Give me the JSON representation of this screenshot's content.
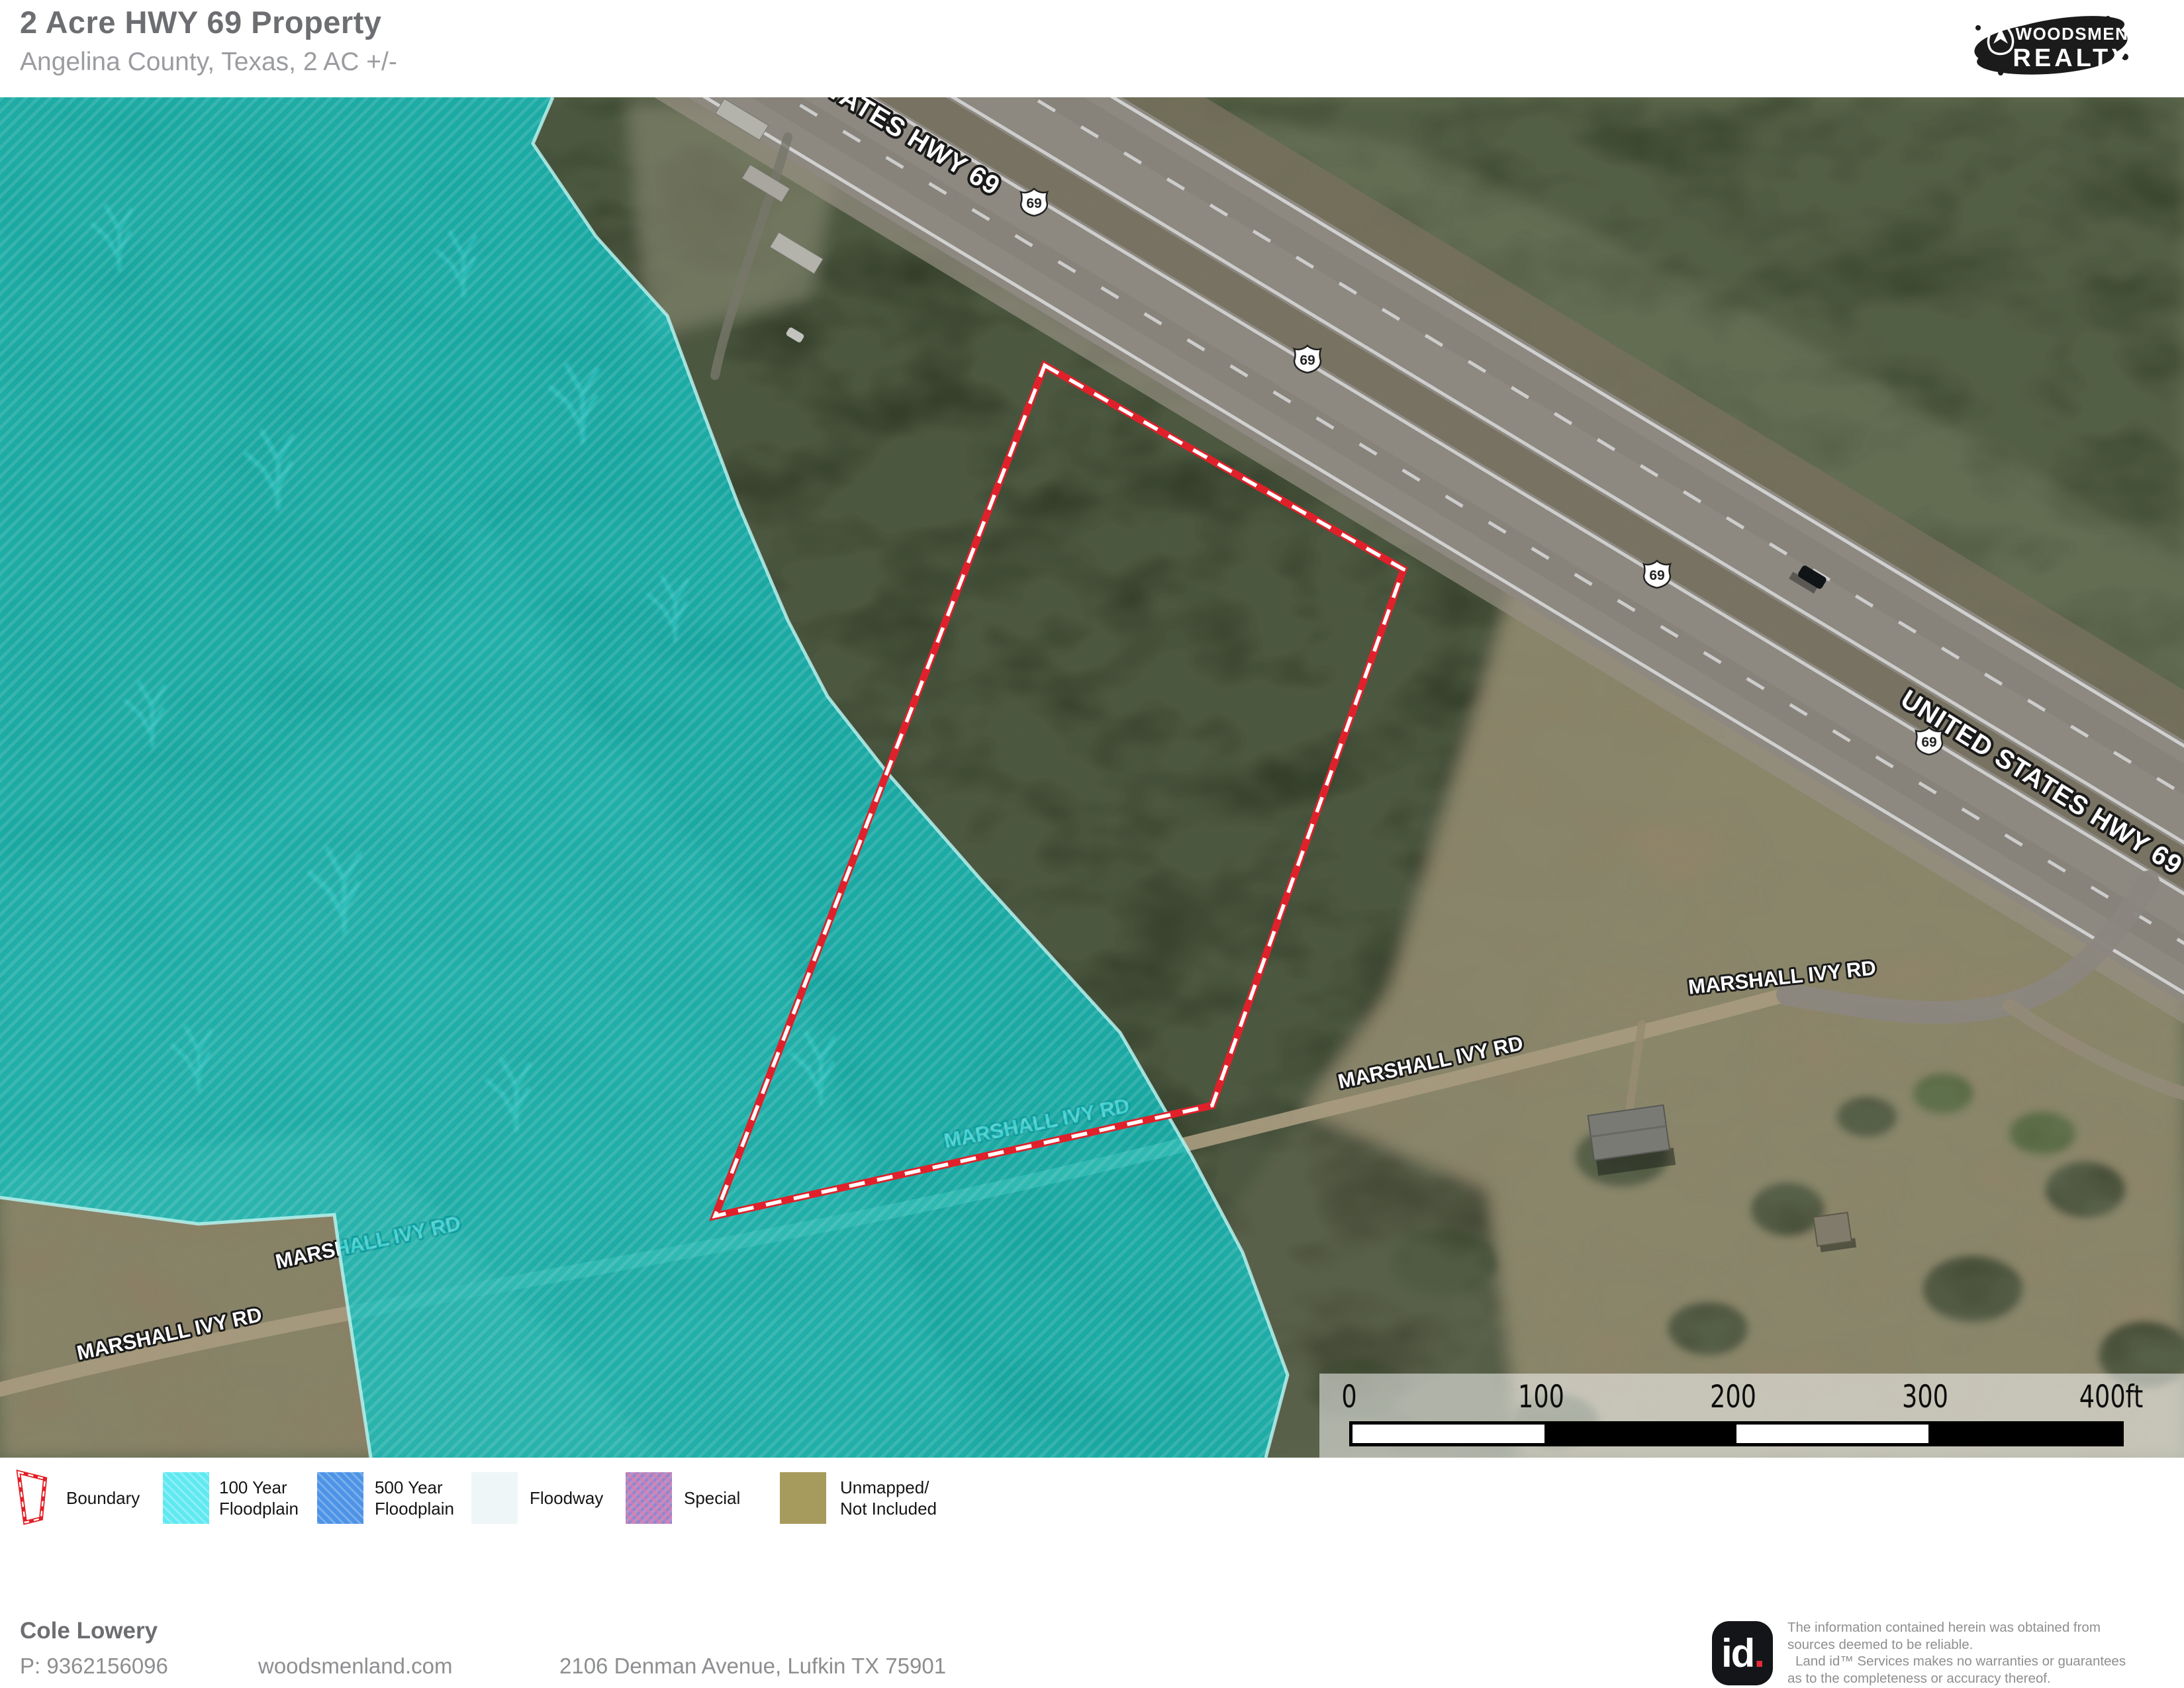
{
  "header": {
    "title": "2 Acre HWY 69 Property",
    "subtitle": "Angelina County, Texas, 2 AC +/-"
  },
  "brand": {
    "line1": "WOODSMEN",
    "line2": "REALTY"
  },
  "map": {
    "highway_label": "UNITED STATES HWY 69",
    "road_label": "MARSHALL IVY RD",
    "route_number": "69"
  },
  "scalebar": {
    "ticks": [
      "0",
      "100",
      "200",
      "300"
    ],
    "end_label": "400ft"
  },
  "legend": {
    "items": [
      {
        "label": "Boundary",
        "color": "#e31e25"
      },
      {
        "line1": "100 Year",
        "line2": "Floodplain",
        "color": "#5fe9f1"
      },
      {
        "line1": "500 Year",
        "line2": "Floodplain",
        "color": "#4d93e6"
      },
      {
        "line1": "Floodway",
        "line2": "",
        "color": "#cfe6ec"
      },
      {
        "line1": "Special",
        "line2": "",
        "color": "#b592ca"
      },
      {
        "line1": "Unmapped/",
        "line2": "Not Included",
        "color": "#a69b5c"
      }
    ]
  },
  "footer": {
    "name": "Cole Lowery",
    "phone": "P: 9362156096",
    "website": "woodsmenland.com",
    "address": "2106 Denman Avenue, Lufkin TX 75901"
  },
  "disclaimer": {
    "logo_text": "id",
    "logo_dot": ".",
    "lines": [
      "The information contained herein was obtained from",
      "sources deemed to be reliable.",
      "Land id™ Services makes no warranties or guarantees",
      "as to the completeness or accuracy thereof."
    ]
  }
}
